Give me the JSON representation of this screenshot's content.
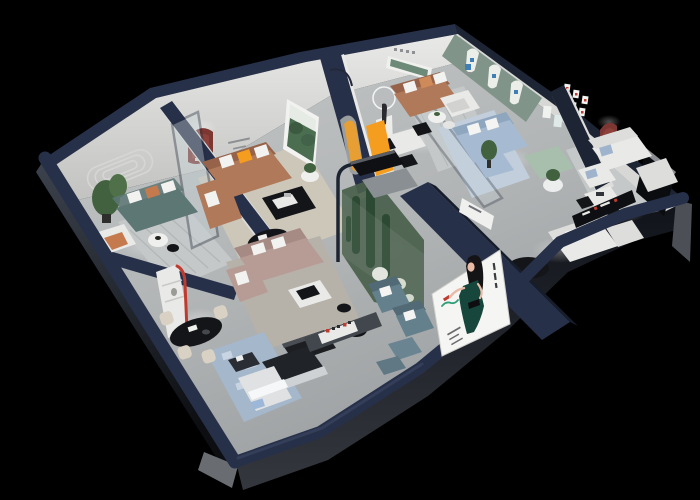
{
  "scene": {
    "background": "#000000",
    "floor": "#b3b6b7",
    "wall_top": "#273049",
    "wall_top_dark": "#1d2534",
    "wall_face": "#e5e5e3",
    "wall_face_shade": "#c6c7c5",
    "exterior_dark": "#15181f",
    "exterior_grey": "#5d6166"
  },
  "colors": {
    "green_wall": "#80948a",
    "red_niche": "#7c3733",
    "accent_red": "#c03b2f",
    "accent_orange": "#f49d1e",
    "brand_green": "#2f9e77",
    "brand_blue": "#3f7fb5",
    "sofa_teal": "#5d7775",
    "sofa_caramel": "#b0795a",
    "sofa_caramel_dark": "#96634a",
    "sofa_blue": "#a6bbd2",
    "sofa_blue_dark": "#8fa6bf",
    "sofa_mauve": "#b79c95",
    "sofa_mauve_dark": "#a68a84",
    "sofa_white": "#e8e8e6",
    "chair_bluegrey": "#64808c",
    "chair_bluegrey_dark": "#526a75",
    "bench_green": "#a8bfad",
    "chair_cream": "#d9d2c4",
    "rug_beige": "#cdc7ba",
    "rug_grey": "#c5c8c8",
    "rug_blue": "#a4b7cb",
    "rug_blue_light": "#c8d4e2",
    "plant_green": "#42613f",
    "cactus_green": "#2c4a33",
    "terrarium_glass": "#49604b",
    "table_black": "#141518",
    "poster_bg": "#f5f5f3",
    "dress_green": "#17463c",
    "skin": "#e9bba6",
    "hair": "#141416"
  }
}
